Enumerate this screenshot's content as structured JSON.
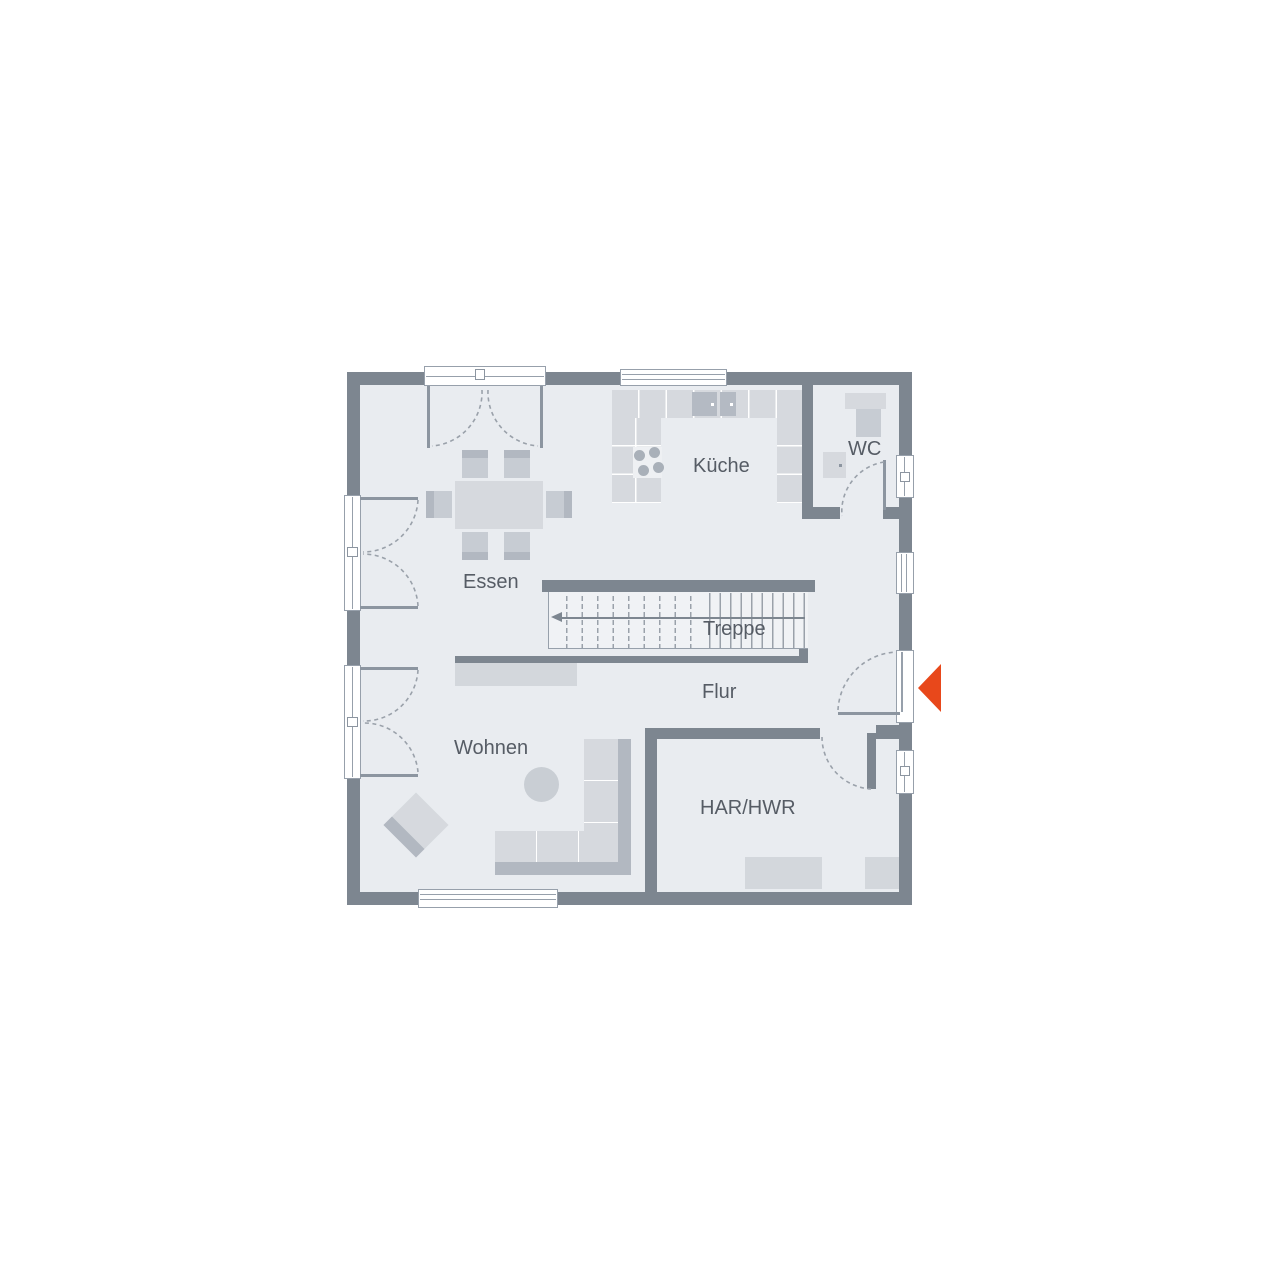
{
  "plan": {
    "type": "floor-plan-ground-floor",
    "rooms": {
      "kitchen": {
        "label": "Küche"
      },
      "wc": {
        "label": "WC"
      },
      "dining": {
        "label": "Essen"
      },
      "stairs": {
        "label": "Treppe"
      },
      "hall": {
        "label": "Flur"
      },
      "living": {
        "label": "Wohnen"
      },
      "utility": {
        "label": "HAR/HWR"
      }
    },
    "colors": {
      "wall": "#7d8690",
      "floor": "#e9ecf0",
      "stairs_bg": "#f0f2f5",
      "line": "#97a0ab",
      "furniture_light": "#d6d9de",
      "furniture_medium": "#c7ccd3",
      "furniture_dark": "#b2b8c1",
      "appliance_dark": "#b4bac3",
      "label_text": "#565c65",
      "entrance_arrow": "#e8481b"
    }
  }
}
